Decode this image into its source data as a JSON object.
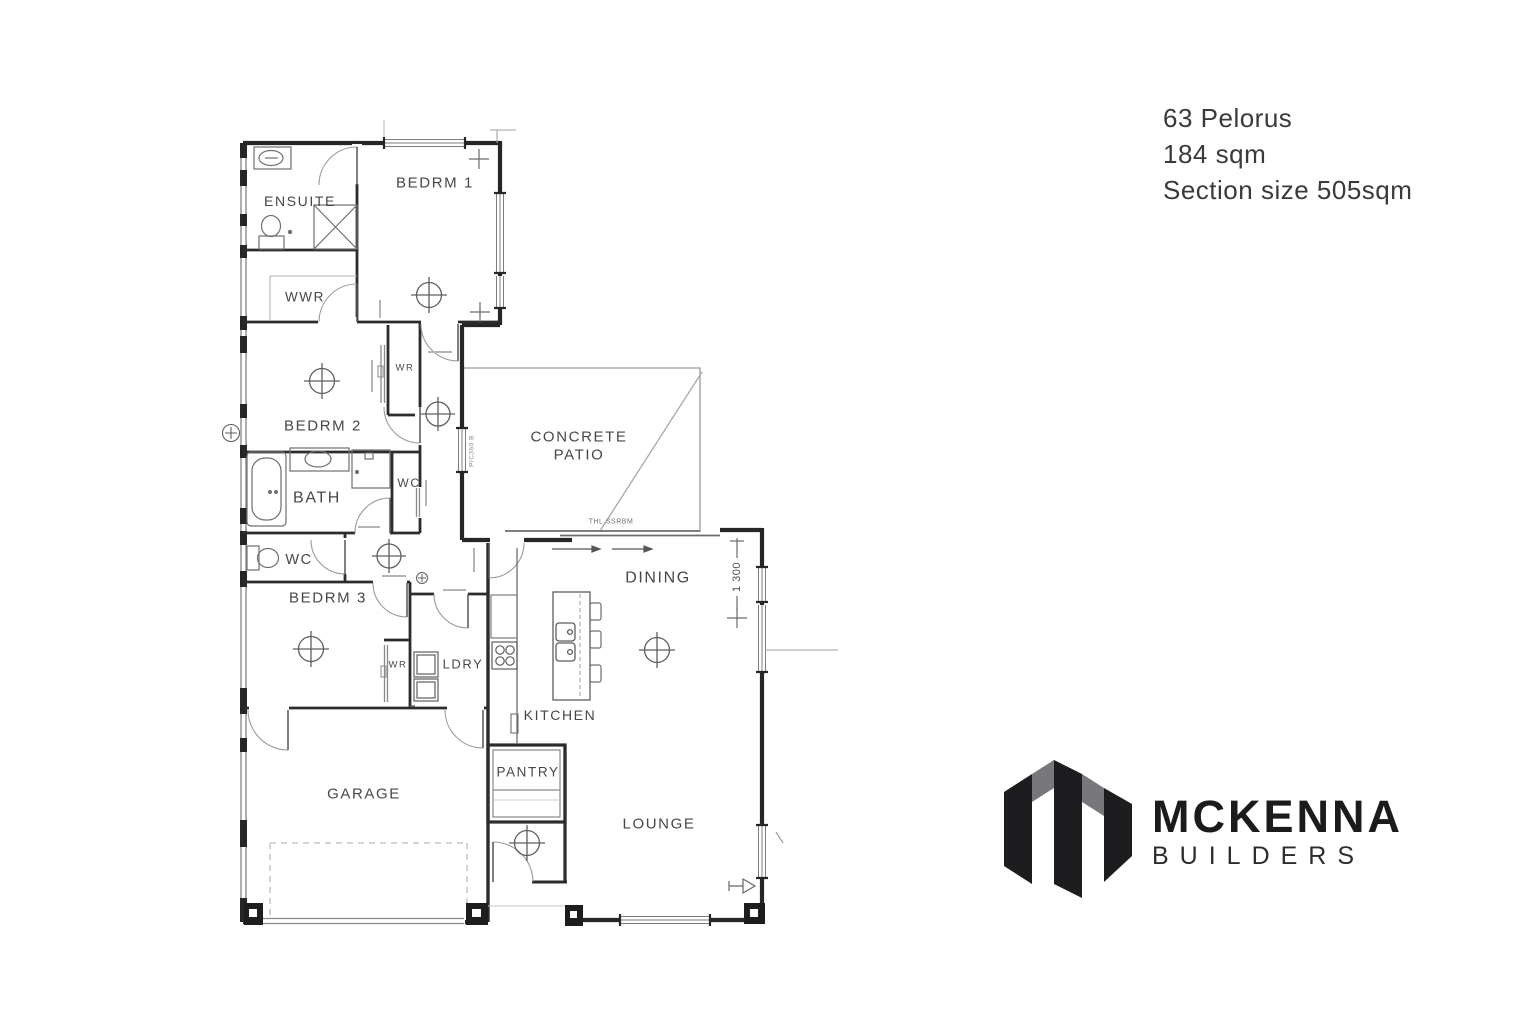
{
  "info_panel": {
    "address": "63 Pelorus",
    "floor_area": "184 sqm",
    "section": "Section size 505sqm"
  },
  "logo": {
    "brand": "MCKENNA",
    "tagline": "BUILDERS",
    "dark": "#1d1d1f",
    "gray": "#77777c"
  },
  "plan": {
    "label_color": "#474747",
    "wall_color": "#262626",
    "rooms": [
      {
        "id": "ensuite",
        "label": "ENSUITE",
        "x": 300,
        "y": 201,
        "size": 14
      },
      {
        "id": "bedrm1",
        "label": "BEDRM 1",
        "x": 435,
        "y": 182,
        "size": 15
      },
      {
        "id": "wwr",
        "label": "WWR",
        "x": 305,
        "y": 297,
        "size": 13.5
      },
      {
        "id": "bedrm2",
        "label": "BEDRM 2",
        "x": 323,
        "y": 425,
        "size": 15
      },
      {
        "id": "wr-bedrm2",
        "label": "WR",
        "x": 405,
        "y": 367,
        "size": 9.5
      },
      {
        "id": "bath",
        "label": "BATH",
        "x": 317,
        "y": 497,
        "size": 16
      },
      {
        "id": "wc-1",
        "label": "WC",
        "x": 409,
        "y": 483,
        "size": 12
      },
      {
        "id": "wc-2",
        "label": "WC",
        "x": 299,
        "y": 559,
        "size": 14.5
      },
      {
        "id": "bedrm3",
        "label": "BEDRM 3",
        "x": 328,
        "y": 597,
        "size": 15
      },
      {
        "id": "wr-bedrm3",
        "label": "WR",
        "x": 398,
        "y": 664,
        "size": 9.5
      },
      {
        "id": "ldry",
        "label": "LDRY",
        "x": 463,
        "y": 664,
        "size": 13
      },
      {
        "id": "kitchen",
        "label": "KITCHEN",
        "x": 560,
        "y": 715,
        "size": 14
      },
      {
        "id": "pantry",
        "label": "PANTRY",
        "x": 528,
        "y": 772,
        "size": 13.5
      },
      {
        "id": "garage",
        "label": "GARAGE",
        "x": 364,
        "y": 793,
        "size": 15
      },
      {
        "id": "patio-line1",
        "label": "CONCRETE",
        "x": 579,
        "y": 436,
        "size": 15
      },
      {
        "id": "patio-line2",
        "label": "PATIO",
        "x": 579,
        "y": 454,
        "size": 15
      },
      {
        "id": "dining",
        "label": "DINING",
        "x": 658,
        "y": 577,
        "size": 16
      },
      {
        "id": "lounge",
        "label": "LOUNGE",
        "x": 659,
        "y": 823,
        "size": 15
      }
    ],
    "annotations": [
      {
        "id": "slider-code",
        "label": "THL.SSRBM",
        "x": 611,
        "y": 521,
        "size": 7,
        "rotate": 0,
        "color": "#6f6f6f"
      },
      {
        "id": "window-code",
        "label": "PIC360 B",
        "x": 471,
        "y": 451,
        "size": 6.5,
        "rotate": -90,
        "color": "#8a8a8a"
      },
      {
        "id": "dim-1300",
        "label": "1 300",
        "x": 736,
        "y": 577,
        "size": 11,
        "rotate": -90,
        "color": "#4f4f4f"
      }
    ]
  }
}
